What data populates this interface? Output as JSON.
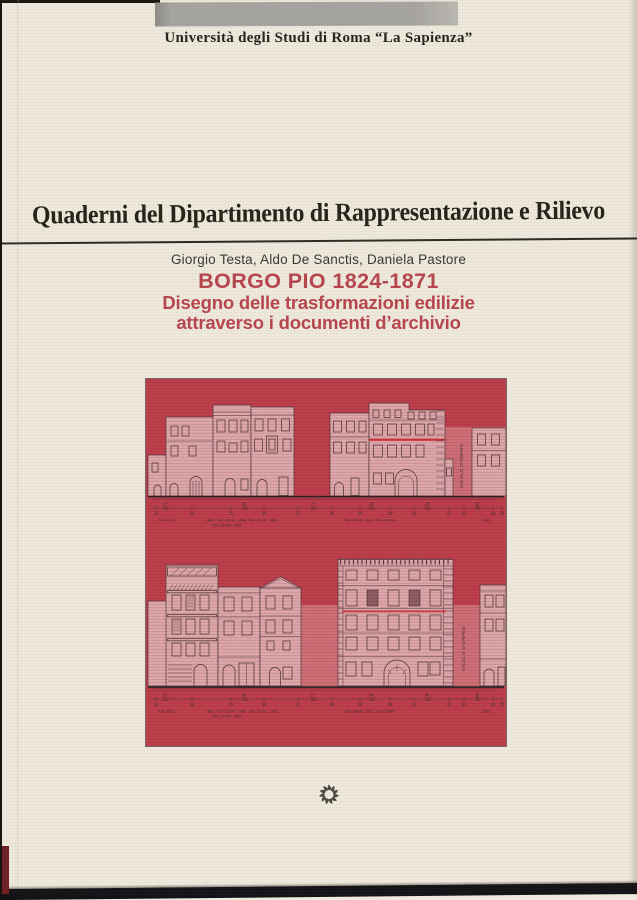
{
  "cover": {
    "affiliation": "Università degli Studi di Roma “La Sapienza”",
    "series_title": "Quaderni del Dipartimento di Rappresentazione e Rilievo",
    "authors": "Giorgio Testa, Aldo De Sanctis, Daniela Pastore",
    "title": "BORGO PIO 1824-1871",
    "subtitle_line1": "Disegno delle trasformazioni edilizie",
    "subtitle_line2": "attraverso i documenti d’archivio"
  },
  "illustration": {
    "street_label_upper": "VICOLO D'ORFEO",
    "street_label_lower": "VICOLO D'ORFEO",
    "ruler_marks": [
      "33",
      "175",
      "34",
      "35",
      "176",
      "36",
      "37",
      "177",
      "38",
      "39",
      "178",
      "40",
      "41",
      "179",
      "42",
      "43",
      "180",
      "44",
      "45"
    ],
    "upper_refs": [
      "T54-3921",
      "1883 T54-31747 1890 T54-21747 1880",
      "T54-75946 1913 T54-75496",
      "1912"
    ],
    "upper_refs_line2": "T54-31499 1906",
    "lower_refs": [
      "T54-3921",
      "1883 T54-31747 1920 T54-31747 1750",
      "T54-38946 1913 T54-75496",
      "1912"
    ],
    "lower_refs_line2": "T54-31499 1906"
  },
  "colors": {
    "paper": "#efeadd",
    "band_gray": "#a7a5a1",
    "panel_red": "#c03e4c",
    "building_pink": "#dfa9ae",
    "accent_red_text": "#b8454e",
    "ink": "#26221d"
  }
}
